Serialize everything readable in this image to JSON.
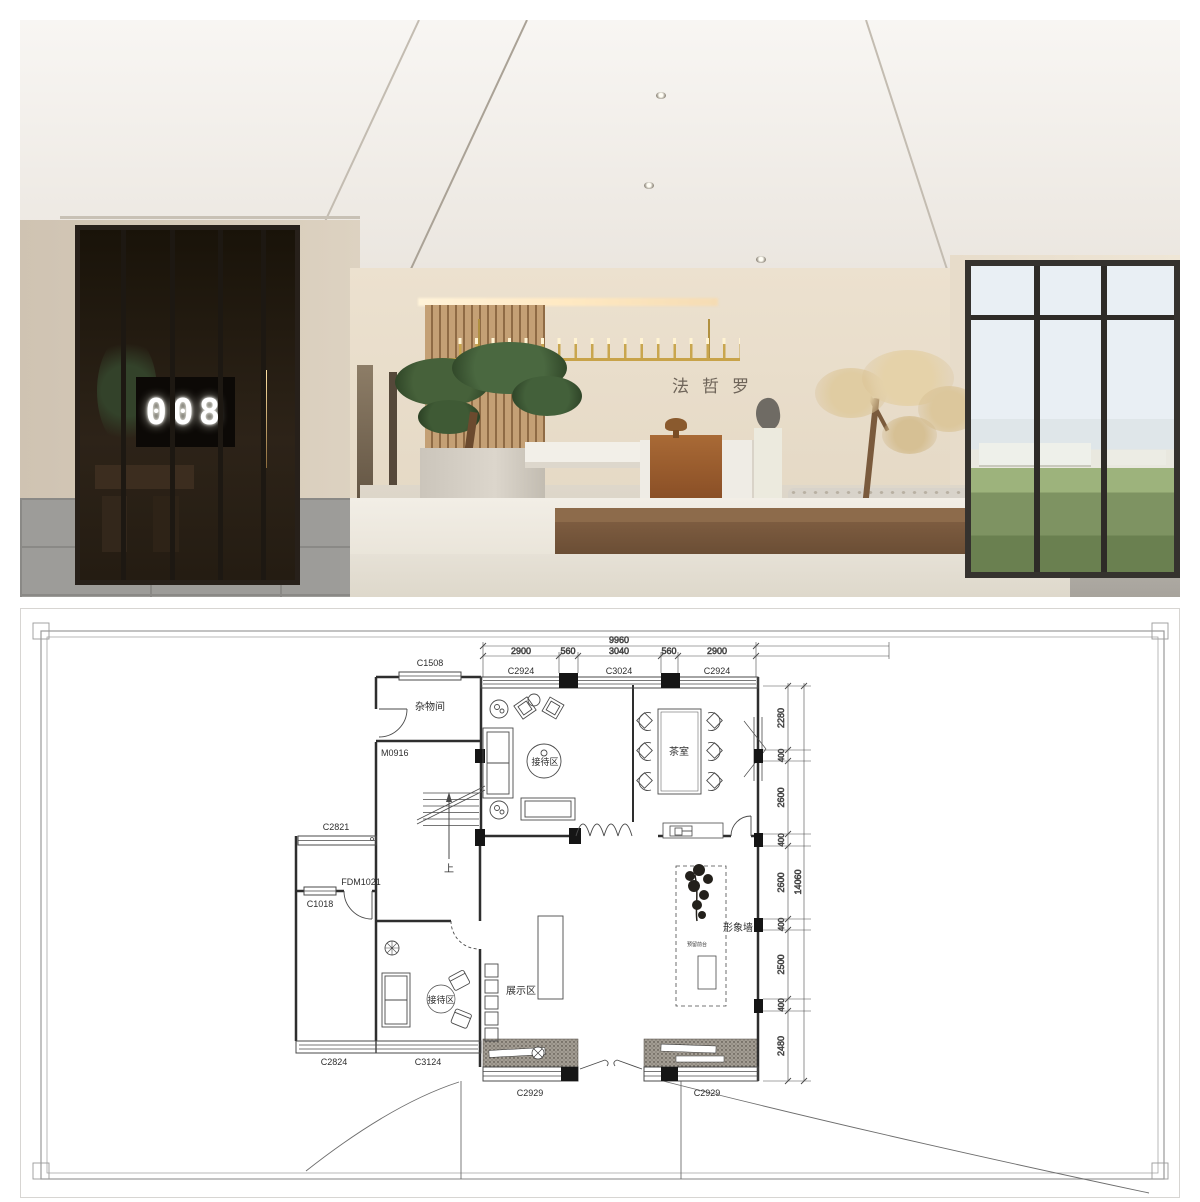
{
  "render": {
    "door_number": "008",
    "wall_sign": "法哲罗"
  },
  "plan": {
    "top_dimensions": {
      "total": "9960",
      "segments": [
        "2900",
        "560",
        "3040",
        "560",
        "2900"
      ]
    },
    "top_window_labels": [
      "C2924",
      "C3024",
      "C2924"
    ],
    "right_dimensions": {
      "total": "14060",
      "segments": [
        "2280",
        "400",
        "2600",
        "400",
        "2600",
        "400",
        "2500",
        "400",
        "2480"
      ]
    },
    "room_labels": {
      "storage": "杂物间",
      "reception_upper": "接待区",
      "tea_room": "茶室",
      "display_area": "展示区",
      "reception_lower": "接待区",
      "feature_wall": "形象墙",
      "reserved_counter": "预留前台",
      "stair_up": "上"
    },
    "opening_labels": {
      "c1508": "C1508",
      "m0916": "M0916",
      "c2821": "C2821",
      "fdm1021": "FDM1021",
      "c1018": "C1018",
      "c2824": "C2824",
      "c3124": "C3124",
      "c2929": "C2929"
    }
  },
  "colors": {
    "chandelier_gold": "#c8a349",
    "wall_beige": "#e6dccb",
    "wood_brown": "#8a5a30",
    "plan_line": "#2e2e2e"
  }
}
